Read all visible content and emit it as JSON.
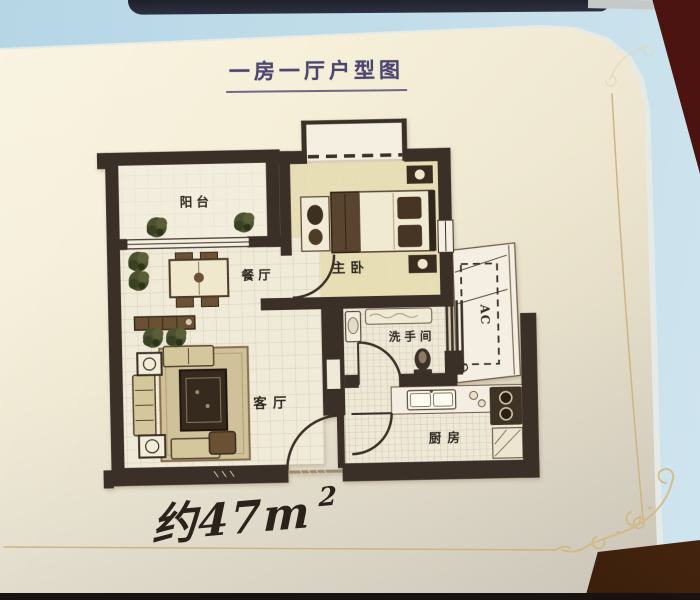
{
  "page": {
    "title": "一房一厅户型图",
    "area_label": "约47m",
    "area_superscript": "2"
  },
  "floor_plan": {
    "labels": {
      "balcony": "阳台",
      "master_bedroom": "主卧",
      "dining_room": "餐厅",
      "living_room": "客厅",
      "bathroom": "洗手间",
      "kitchen": "厨房",
      "ac_platform": "AC"
    }
  },
  "colors": {
    "wall_ink": "#3a3027",
    "page_cream": "#f4eed8",
    "gold_accent": "#cdb484",
    "title_ink": "#4d4770",
    "photo_blue": "#b6d6e6",
    "wood_dark": "#46260f"
  }
}
